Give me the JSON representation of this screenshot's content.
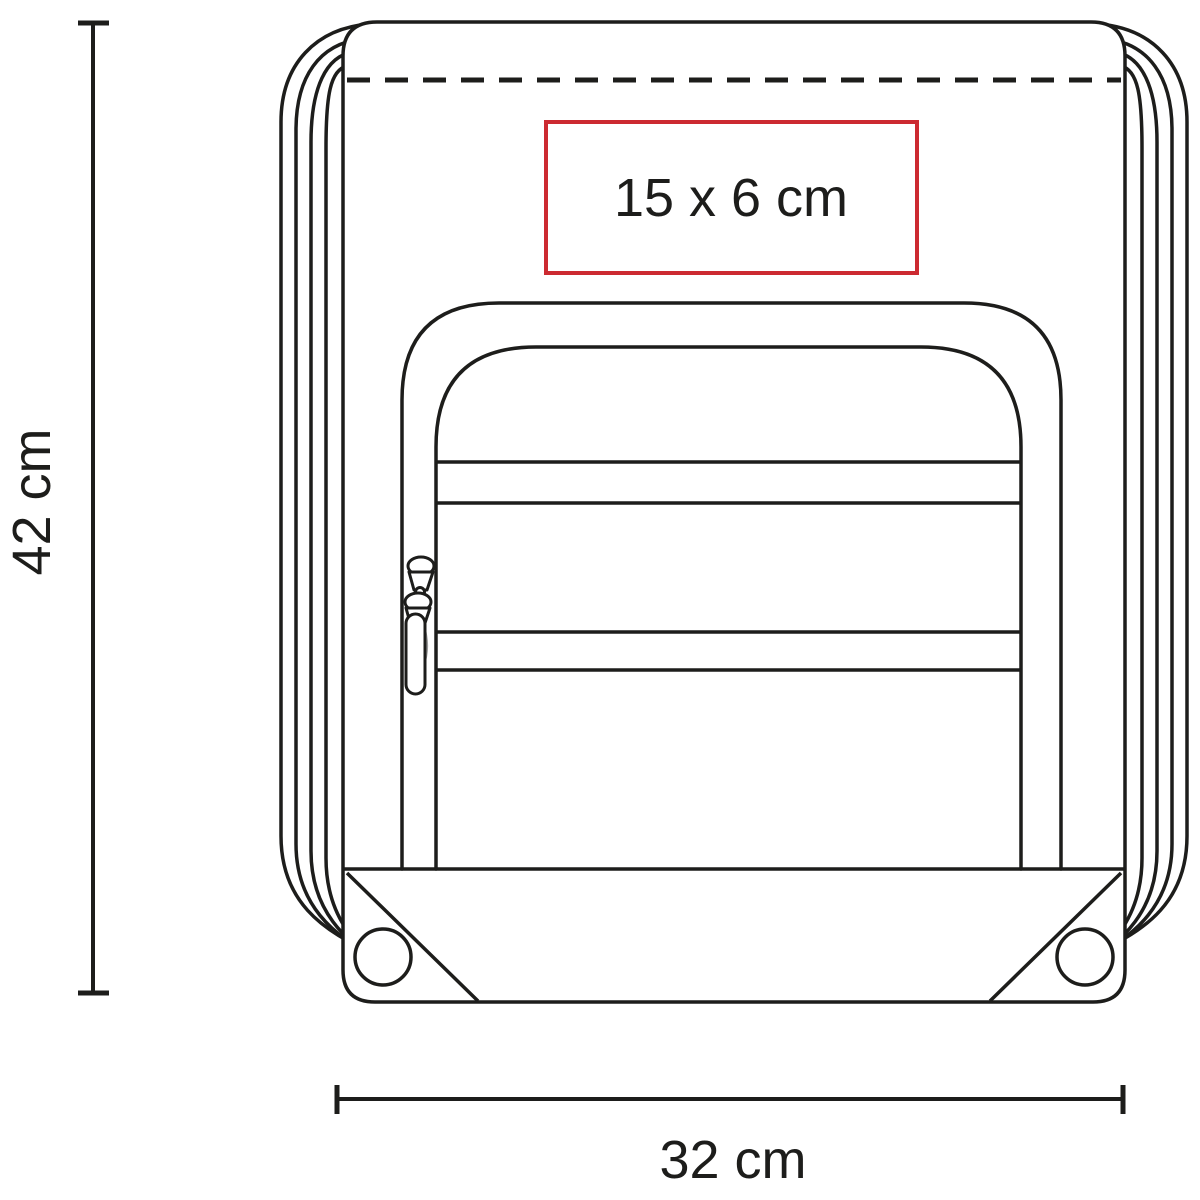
{
  "diagram": {
    "subject": "drawstring backpack technical line drawing",
    "dimensions": {
      "height": {
        "label": "42 cm",
        "value": 42,
        "unit": "cm"
      },
      "width": {
        "label": "32 cm",
        "value": 32,
        "unit": "cm"
      }
    },
    "print_area": {
      "label": "15 x 6 cm",
      "width_cm": 15,
      "height_cm": 6
    },
    "colors": {
      "line_color": "#1d1d1b",
      "accent_red": "#cc2a31",
      "zipper_gray": "#9a9a9a",
      "background": "#ffffff"
    }
  }
}
